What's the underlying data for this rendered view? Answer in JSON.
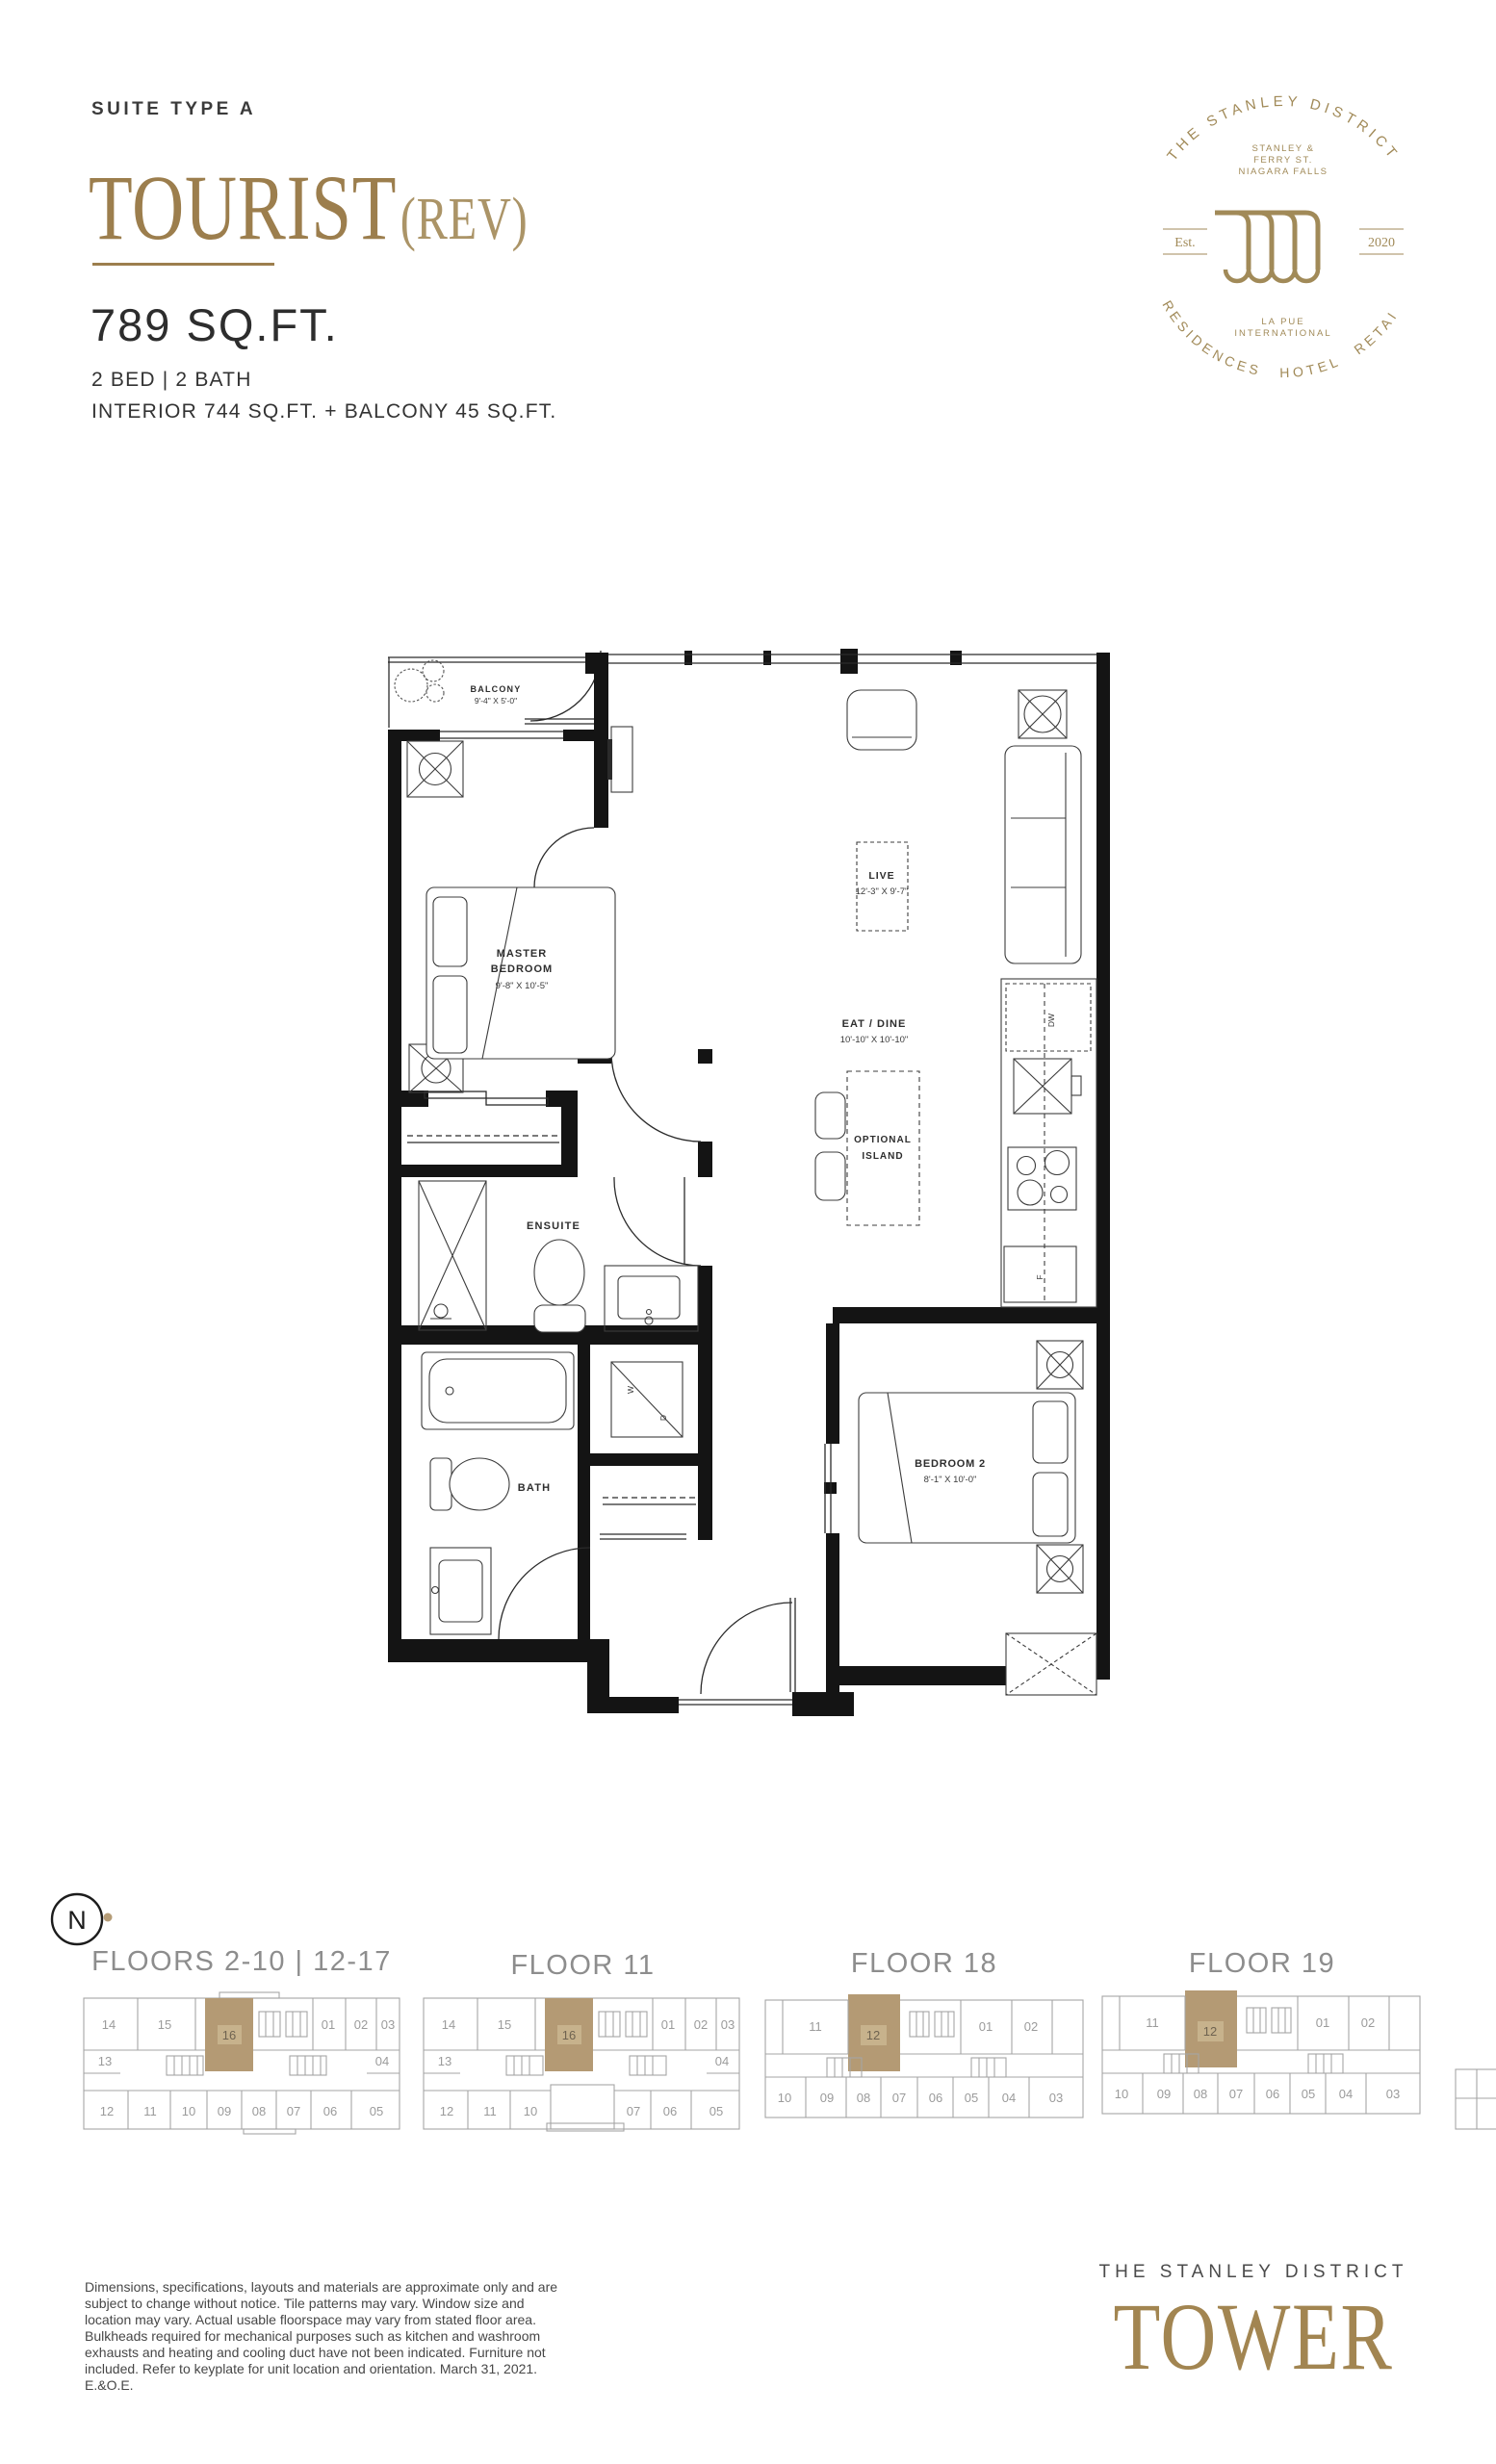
{
  "header": {
    "suite_type": "SUITE TYPE A",
    "name": "TOURIST",
    "rev": "(REV)",
    "area": "789  SQ.FT.",
    "bed_bath": "2 BED  |  2 BATH",
    "interior": "INTERIOR 744 SQ.FT. + BALCONY 45 SQ.FT."
  },
  "logo": {
    "arc_top": "THE STANLEY DISTRICT",
    "address_1": "STANLEY &",
    "address_2": "FERRY ST.",
    "address_3": "NIAGARA FALLS",
    "est": "Est.",
    "year": "2020",
    "brand_1": "LA PUE",
    "brand_2": "INTERNATIONAL",
    "arc_bottom": "RESIDENCES  HOTEL  RETAIL"
  },
  "plan": {
    "balcony": {
      "name": "BALCONY",
      "dim": "9'-4\" X 5'-0\""
    },
    "master": {
      "name_1": "MASTER",
      "name_2": "BEDROOM",
      "dim": "9'-8\" X 10'-5\""
    },
    "live": {
      "name": "LIVE",
      "dim": "12'-3\" X 9'-7\""
    },
    "eat_dine": {
      "name": "EAT / DINE",
      "dim": "10'-10\" X 10'-10\""
    },
    "island": {
      "name_1": "OPTIONAL",
      "name_2": "ISLAND"
    },
    "ensuite": {
      "name": "ENSUITE"
    },
    "bath": {
      "name": "BATH"
    },
    "bedroom2": {
      "name": "BEDROOM 2",
      "dim": "8'-1\" X 10'-0\""
    },
    "appliances": {
      "dw": "DW",
      "fridge": "F",
      "washer": "W",
      "dryer": "D"
    }
  },
  "compass": {
    "label": "N"
  },
  "keyplates": [
    {
      "title": "FLOORS 2-10 | 12-17",
      "highlight": "16",
      "units": [
        "14",
        "15",
        "16",
        "01",
        "02",
        "03",
        "13",
        "04",
        "12",
        "11",
        "10",
        "09",
        "08",
        "07",
        "06",
        "05"
      ]
    },
    {
      "title": "FLOOR 11",
      "highlight": "16",
      "units": [
        "14",
        "15",
        "16",
        "01",
        "02",
        "03",
        "13",
        "04",
        "12",
        "11",
        "10",
        "07",
        "06",
        "05"
      ]
    },
    {
      "title": "FLOOR 18",
      "highlight": "12",
      "units": [
        "11",
        "12",
        "01",
        "02",
        "10",
        "09",
        "08",
        "07",
        "06",
        "05",
        "04",
        "03"
      ]
    },
    {
      "title": "FLOOR 19",
      "highlight": "12",
      "units": [
        "11",
        "12",
        "01",
        "02",
        "10",
        "09",
        "08",
        "07",
        "06",
        "05",
        "04",
        "03"
      ]
    }
  ],
  "disclaimer": "Dimensions, specifications, layouts and materials are approximate only and are subject to change without notice. Tile patterns may vary. Window size and location may vary. Actual usable floorspace may vary from stated floor area. Bulkheads required for mechanical purposes such as kitchen and washroom exhausts and heating and cooling duct have not been indicated. Furniture not included. Refer to keyplate for unit location and orientation. March 31, 2021. E.&O.E.",
  "footer": {
    "brand_top": "THE  STANLEY  DISTRICT",
    "brand_name": "TOWER"
  },
  "colors": {
    "gold": "#9c7e4d",
    "logo_gold": "#a18a58",
    "highlight_tan": "#b49a74"
  }
}
